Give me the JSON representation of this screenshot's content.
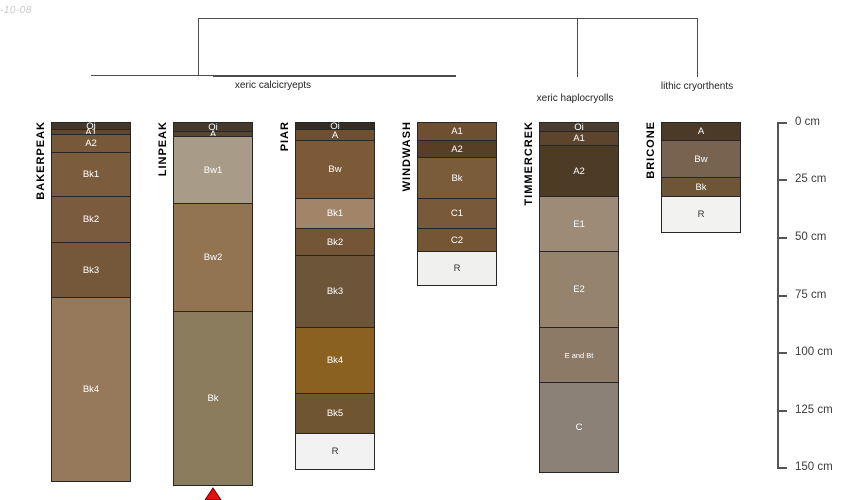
{
  "meta": {
    "timestamp_fragment": "-10-08"
  },
  "taxonomy": {
    "group_labels": [
      "xeric calcicryepts",
      "xeric haplocryolls",
      "lithic cryorthents"
    ]
  },
  "depth_axis": {
    "unit": "cm",
    "tick_values": [
      0,
      25,
      50,
      75,
      100,
      125,
      150
    ],
    "tick_labels": [
      "0 cm",
      "25 cm",
      "50 cm",
      "75 cm",
      "100 cm",
      "125 cm",
      "150 cm"
    ]
  },
  "chart_data": {
    "type": "bar",
    "variant": "soil-profile-depth-columns-with-taxonomy-dendrogram",
    "ylabel": "depth (cm)",
    "ylim": [
      0,
      150
    ],
    "groups": [
      {
        "label": "xeric calcicryepts",
        "profiles": [
          "BAKERPEAK",
          "LINPEAK",
          "PIAR",
          "WINDWASH"
        ]
      },
      {
        "label": "xeric haplocryolls",
        "profiles": [
          "TIMMERCREK"
        ]
      },
      {
        "label": "lithic cryorthents",
        "profiles": [
          "BRICONE"
        ]
      }
    ],
    "profiles": [
      {
        "name": "BAKERPEAK",
        "truncated": false,
        "horizons": [
          {
            "name": "Oi",
            "top": 0,
            "bottom": 3,
            "color": "#44382c"
          },
          {
            "name": "A1",
            "top": 3,
            "bottom": 5,
            "color": "#5f4831"
          },
          {
            "name": "A2",
            "top": 5,
            "bottom": 13,
            "color": "#77593a"
          },
          {
            "name": "Bk1",
            "top": 13,
            "bottom": 32,
            "color": "#7b5c3d"
          },
          {
            "name": "Bk2",
            "top": 32,
            "bottom": 52,
            "color": "#7a5b3d"
          },
          {
            "name": "Bk3",
            "top": 52,
            "bottom": 76,
            "color": "#75573a"
          },
          {
            "name": "Bk4",
            "top": 76,
            "bottom": 156,
            "color": "#96795a"
          }
        ]
      },
      {
        "name": "LINPEAK",
        "truncated": true,
        "horizons": [
          {
            "name": "Oi",
            "top": 0,
            "bottom": 4,
            "color": "#453a2e"
          },
          {
            "name": "A",
            "top": 4,
            "bottom": 6,
            "color": "#584530"
          },
          {
            "name": "Bw1",
            "top": 6,
            "bottom": 35,
            "color": "#a89b88"
          },
          {
            "name": "Bw2",
            "top": 35,
            "bottom": 82,
            "color": "#937450"
          },
          {
            "name": "Bk",
            "top": 82,
            "bottom": 158,
            "color": "#8b7c5d"
          }
        ]
      },
      {
        "name": "PIAR",
        "truncated": false,
        "horizons": [
          {
            "name": "Oi",
            "top": 0,
            "bottom": 3,
            "color": "#352c23"
          },
          {
            "name": "A",
            "top": 3,
            "bottom": 8,
            "color": "#6e4f30"
          },
          {
            "name": "Bw",
            "top": 8,
            "bottom": 33,
            "color": "#7c5a38"
          },
          {
            "name": "Bk1",
            "top": 33,
            "bottom": 46,
            "color": "#a28468"
          },
          {
            "name": "Bk2",
            "top": 46,
            "bottom": 58,
            "color": "#745535"
          },
          {
            "name": "Bk3",
            "top": 58,
            "bottom": 89,
            "color": "#6d5539"
          },
          {
            "name": "Bk4",
            "top": 89,
            "bottom": 118,
            "color": "#8a6120"
          },
          {
            "name": "Bk5",
            "top": 118,
            "bottom": 135,
            "color": "#6f5530"
          },
          {
            "name": "R",
            "top": 135,
            "bottom": 151,
            "color": "#f2f2f2"
          }
        ]
      },
      {
        "name": "WINDWASH",
        "truncated": false,
        "horizons": [
          {
            "name": "A1",
            "top": 0,
            "bottom": 8,
            "color": "#6e4f31"
          },
          {
            "name": "A2",
            "top": 8,
            "bottom": 15,
            "color": "#573e24"
          },
          {
            "name": "Bk",
            "top": 15,
            "bottom": 33,
            "color": "#7a5c3b"
          },
          {
            "name": "C1",
            "top": 33,
            "bottom": 46,
            "color": "#785939"
          },
          {
            "name": "C2",
            "top": 46,
            "bottom": 56,
            "color": "#745635"
          },
          {
            "name": "R",
            "top": 56,
            "bottom": 71,
            "color": "#f0f0ee"
          }
        ]
      },
      {
        "name": "TIMMERCREK",
        "truncated": false,
        "horizons": [
          {
            "name": "Oi",
            "top": 0,
            "bottom": 4,
            "color": "#483d30"
          },
          {
            "name": "A1",
            "top": 4,
            "bottom": 10,
            "color": "#5c452c"
          },
          {
            "name": "A2",
            "top": 10,
            "bottom": 32,
            "color": "#4e3b26"
          },
          {
            "name": "E1",
            "top": 32,
            "bottom": 56,
            "color": "#9d8b77"
          },
          {
            "name": "E2",
            "top": 56,
            "bottom": 89,
            "color": "#95836e"
          },
          {
            "name": "E and Bt",
            "top": 89,
            "bottom": 113,
            "color": "#8d7a66"
          },
          {
            "name": "C",
            "top": 113,
            "bottom": 152,
            "color": "#8b8177"
          }
        ]
      },
      {
        "name": "BRICONE",
        "truncated": false,
        "horizons": [
          {
            "name": "A",
            "top": 0,
            "bottom": 8,
            "color": "#4a3a27"
          },
          {
            "name": "Bw",
            "top": 8,
            "bottom": 24,
            "color": "#786350"
          },
          {
            "name": "Bk",
            "top": 24,
            "bottom": 32,
            "color": "#6d5535"
          },
          {
            "name": "R",
            "top": 32,
            "bottom": 48,
            "color": "#f2f2f0"
          }
        ]
      }
    ],
    "marker": {
      "type": "truncation-triangle",
      "profile": "LINPEAK",
      "color": "#ee0d0d"
    }
  }
}
